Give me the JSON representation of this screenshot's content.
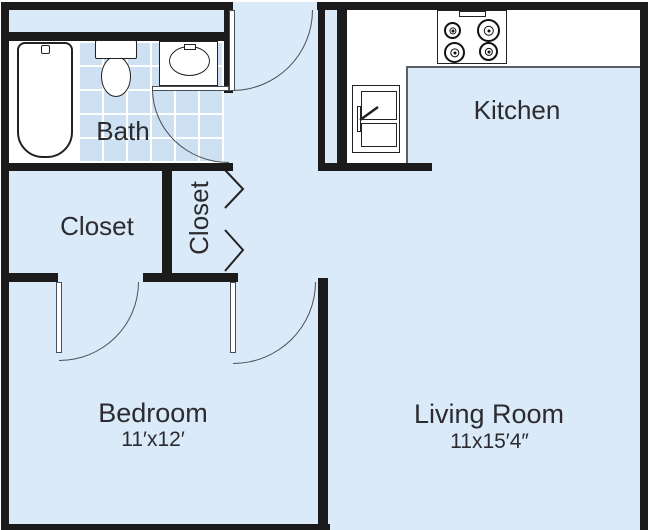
{
  "title": "Apartment floor plan",
  "rooms": {
    "bath": {
      "label": "Bath"
    },
    "kitchen": {
      "label": "Kitchen"
    },
    "closet_large": {
      "label": "Closet"
    },
    "closet_small": {
      "label": "Closet"
    },
    "bedroom": {
      "label": "Bedroom",
      "dimensions": "11′x12′"
    },
    "living_room": {
      "label": "Living Room",
      "dimensions": "11x15′4″"
    }
  },
  "fixtures": [
    "bathtub-icon",
    "toilet-icon",
    "sink-icon",
    "stove-icon",
    "refrigerator-icon",
    "bifold-door-icon",
    "swing-door-icon"
  ],
  "colors": {
    "floor": "#dbeaf8",
    "tile": "#cde1f2",
    "wall": "#1b1b1b",
    "text": "#2b2b31",
    "fixture_border": "#222222",
    "arc": "#4a4f55",
    "counter_edge": "#5a6067",
    "white": "#ffffff"
  }
}
